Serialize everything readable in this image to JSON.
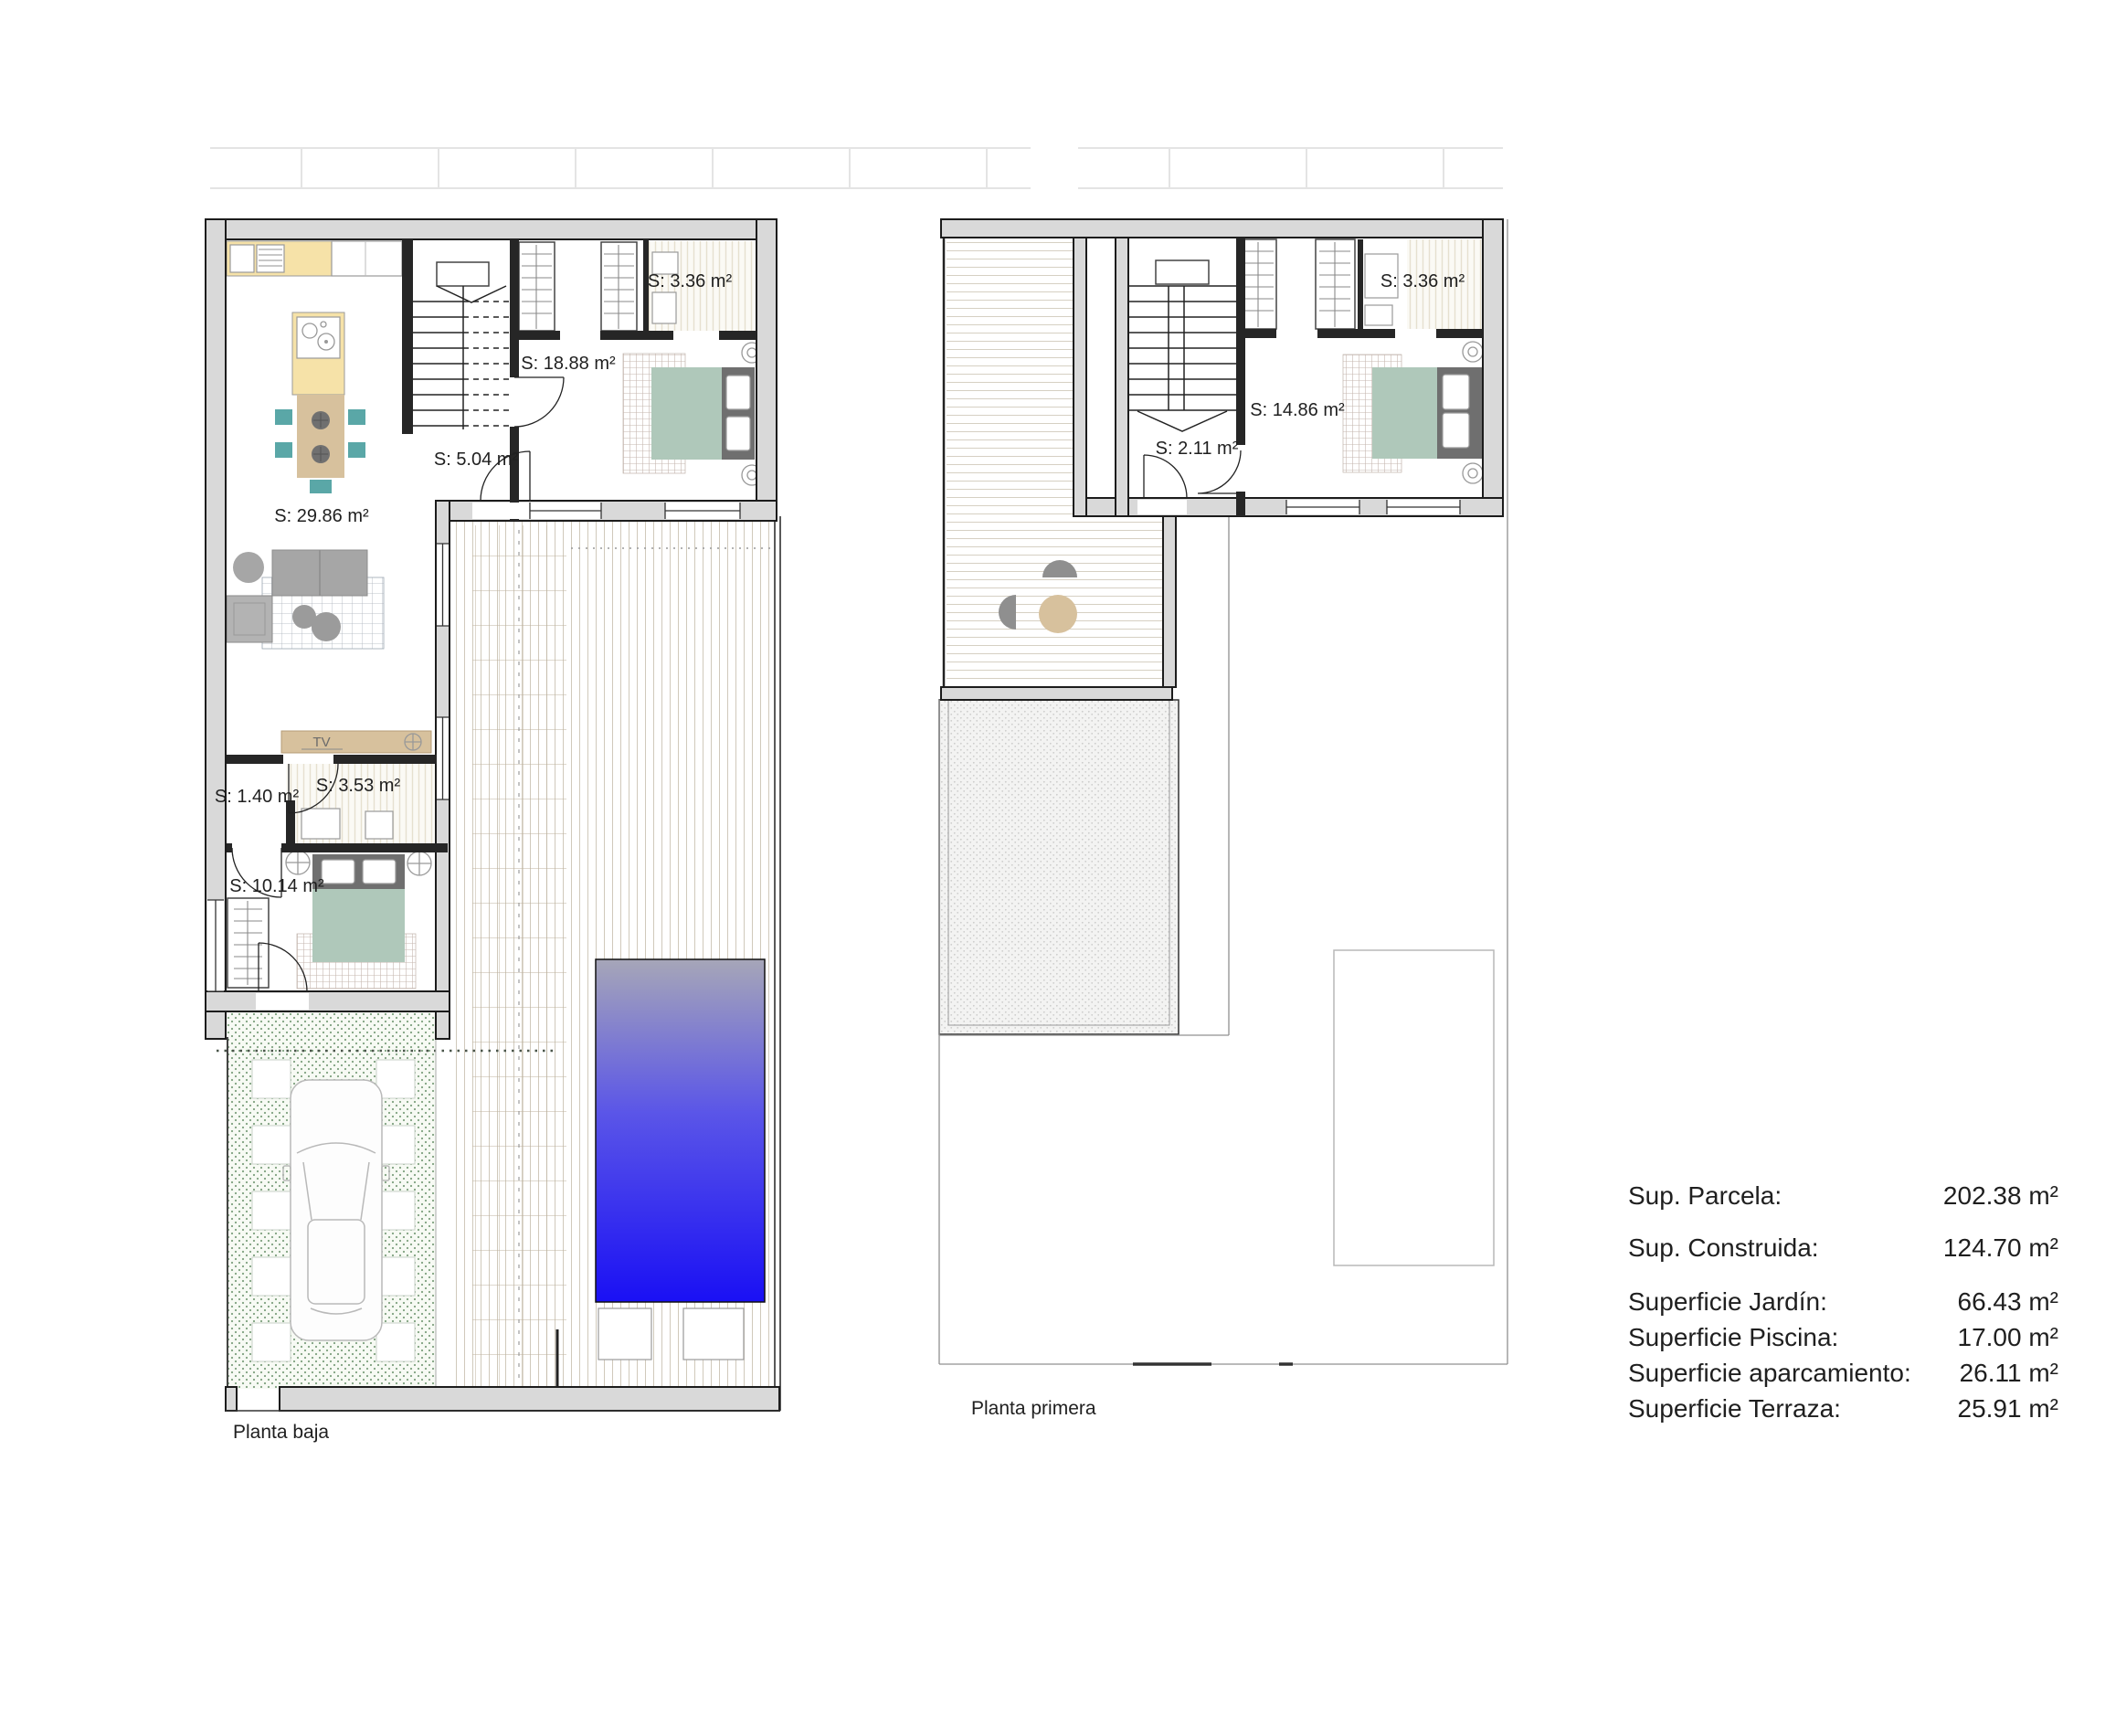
{
  "planta_baja": {
    "title": "Planta baja",
    "rooms": {
      "bath_top": "S: 3.36 m²",
      "bedroom_main": "S: 18.88 m²",
      "hall": "S: 5.04 m²",
      "living": "S: 29.86 m²",
      "hall_small": "S: 1.40 m²",
      "bath_small": "S: 3.53 m²",
      "bedroom_2": "S: 10.14 m²"
    },
    "tv": "TV"
  },
  "planta_primera": {
    "title": "Planta primera",
    "rooms": {
      "bath_top": "S: 3.36 m²",
      "bedroom": "S: 14.86 m²",
      "hall": "S: 2.11 m²"
    }
  },
  "legend": {
    "rows": [
      {
        "label": "Sup. Parcela:",
        "value": "202.38 m²"
      },
      {
        "label": "Sup. Construida:",
        "value": "124.70 m²"
      },
      {
        "label": "Superficie Jardín:",
        "value": "66.43 m²"
      },
      {
        "label": "Superficie Piscina:",
        "value": "17.00 m²"
      },
      {
        "label": "Superficie aparcamiento:",
        "value": "26.11 m²"
      },
      {
        "label": "Superficie Terraza:",
        "value": "25.91 m²"
      }
    ]
  },
  "colors": {
    "wall_gray": "#d9d9d9",
    "kitchen_yellow": "#f6e2a8",
    "wood_tan": "#d7c19d",
    "chair_teal": "#5aa7a7",
    "sofa_gray": "#a6a6a6",
    "bed_green": "#afc8ba",
    "headboard_gray": "#6f6f6f",
    "garden_green": "#7fa17f",
    "pool_top": "#a6a6b8",
    "pool_mid": "#5a55e8",
    "pool_deep": "#1a10f4"
  }
}
